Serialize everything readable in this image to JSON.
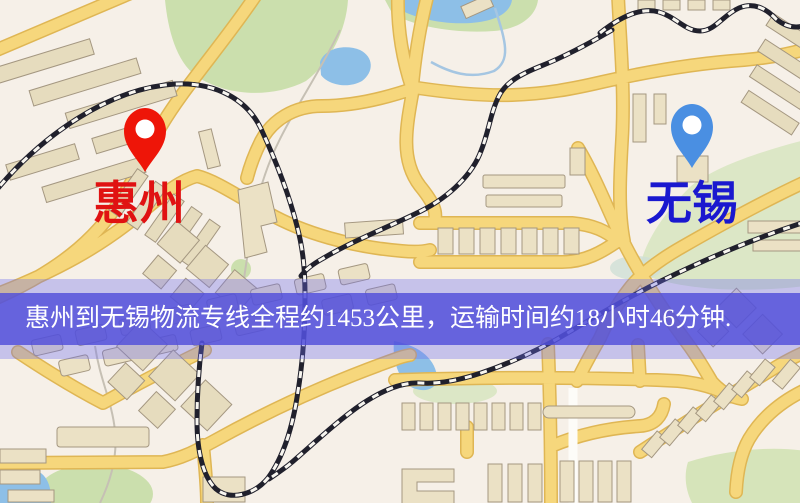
{
  "markers": {
    "origin": {
      "label": "惠州",
      "pin_color": "#ee1508",
      "label_color": "#e01212"
    },
    "destination": {
      "label": "无锡",
      "pin_color": "#4a8fe2",
      "label_color": "#1a18cf"
    }
  },
  "banner": {
    "text": "惠州到无锡物流专线全程约1453公里，运输时间约18小时46分钟.",
    "text_color": "#ffffff",
    "background_color": "#504ed9",
    "route": {
      "origin": "惠州",
      "destination": "无锡",
      "distance_km": "1453",
      "duration_hours": "18",
      "duration_minutes": "46"
    }
  },
  "map_colors": {
    "background": "#f6f0e8",
    "road": "#f6d77c",
    "building": "#ebe1c5",
    "park": "#cbdfad",
    "water": "#8dbfe7",
    "railway": "#20202c"
  }
}
